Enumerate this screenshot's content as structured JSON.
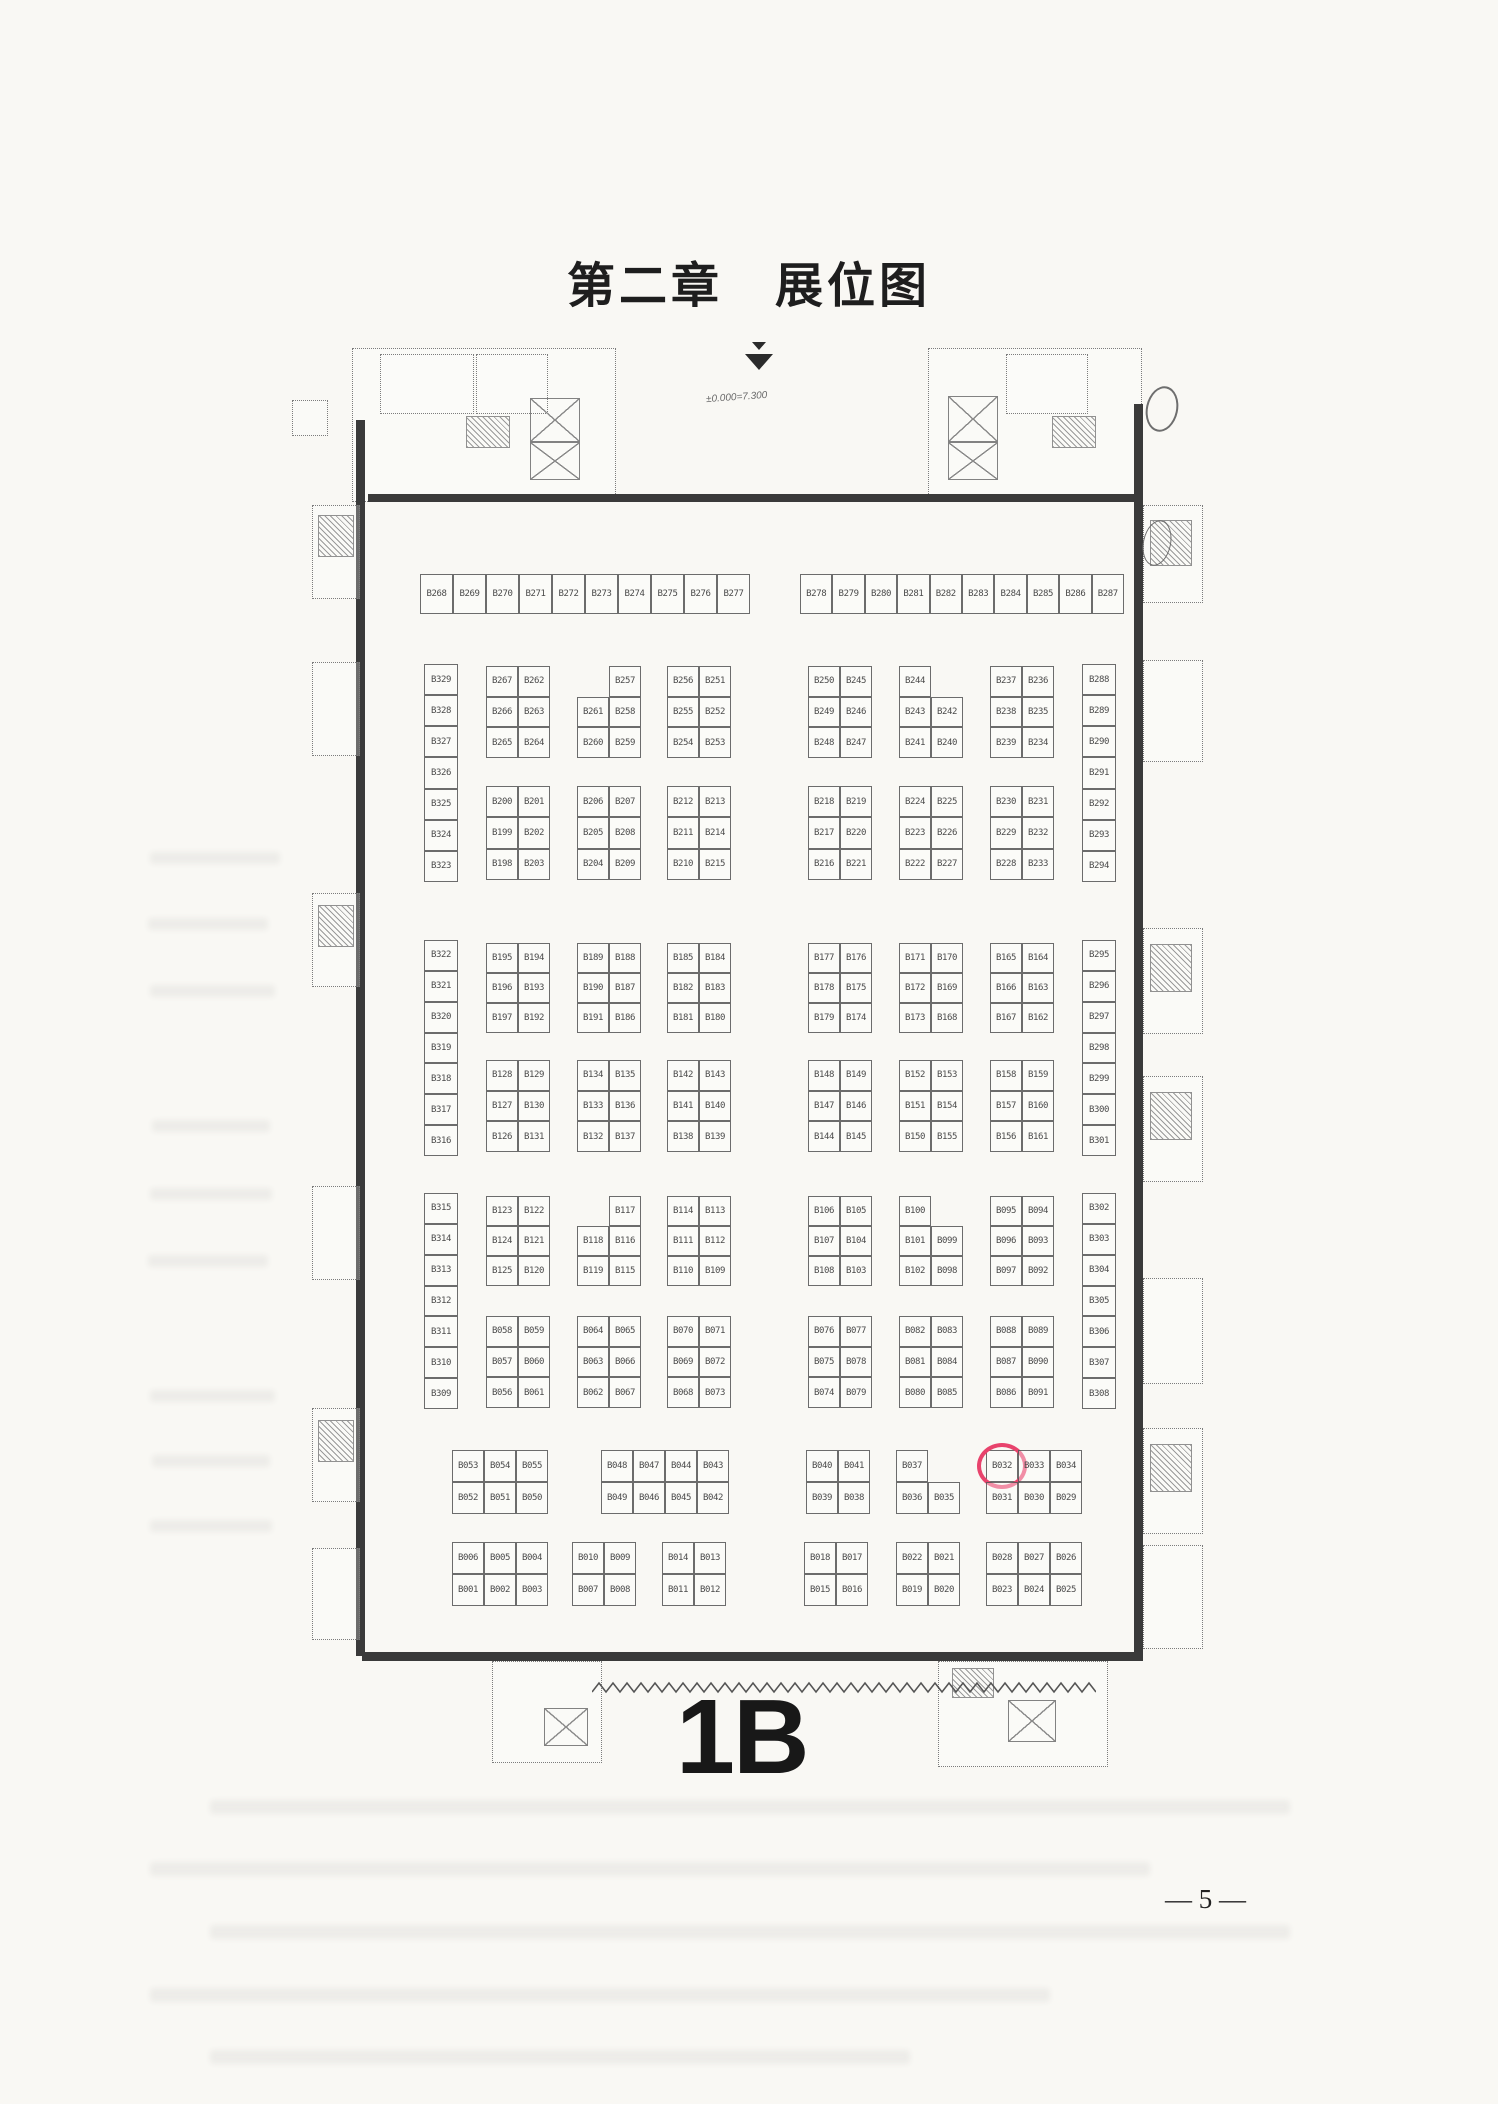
{
  "document": {
    "title": "第二章　展位图",
    "hall_label": "1B",
    "page_number": "— 5 —",
    "elevation_note": "±0.000=7.300",
    "highlighted_booth": "B032",
    "highlight_color": "#e8436c",
    "ink_color": "#3a3a3a",
    "paper_color": "#f9f8f4"
  },
  "plan": {
    "blocks": [
      {
        "x": 420,
        "y": 574,
        "w": 330,
        "h": 40,
        "cols": 10,
        "rows": 1,
        "cells": [
          "B268",
          "B269",
          "B270",
          "B271",
          "B272",
          "B273",
          "B274",
          "B275",
          "B276",
          "B277"
        ]
      },
      {
        "x": 800,
        "y": 574,
        "w": 324,
        "h": 40,
        "cols": 10,
        "rows": 1,
        "cells": [
          "B278",
          "B279",
          "B280",
          "B281",
          "B282",
          "B283",
          "B284",
          "B285",
          "B286",
          "B287"
        ]
      },
      {
        "x": 424,
        "y": 664,
        "w": 34,
        "h": 218,
        "cols": 1,
        "rows": 7,
        "cells": [
          "B329",
          "B328",
          "B327",
          "B326",
          "B325",
          "B324",
          "B323"
        ]
      },
      {
        "x": 486,
        "y": 666,
        "w": 64,
        "h": 92,
        "cols": 2,
        "rows": 3,
        "cells": [
          "B267",
          "B262",
          "B266",
          "B263",
          "B265",
          "B264"
        ]
      },
      {
        "x": 577,
        "y": 666,
        "w": 64,
        "h": 92,
        "cols": 2,
        "rows": 3,
        "cells": [
          "",
          "B257",
          "B261",
          "B258",
          "B260",
          "B259"
        ]
      },
      {
        "x": 667,
        "y": 666,
        "w": 64,
        "h": 92,
        "cols": 2,
        "rows": 3,
        "cells": [
          "B256",
          "B251",
          "B255",
          "B252",
          "B254",
          "B253"
        ]
      },
      {
        "x": 808,
        "y": 666,
        "w": 64,
        "h": 92,
        "cols": 2,
        "rows": 3,
        "cells": [
          "B250",
          "B245",
          "B249",
          "B246",
          "B248",
          "B247"
        ]
      },
      {
        "x": 899,
        "y": 666,
        "w": 64,
        "h": 92,
        "cols": 2,
        "rows": 3,
        "cells": [
          "B244",
          "",
          "B243",
          "B242",
          "B241",
          "B240"
        ]
      },
      {
        "x": 990,
        "y": 666,
        "w": 64,
        "h": 92,
        "cols": 2,
        "rows": 3,
        "cells": [
          "B237",
          "B236",
          "B238",
          "B235",
          "B239",
          "B234"
        ]
      },
      {
        "x": 1082,
        "y": 664,
        "w": 34,
        "h": 218,
        "cols": 1,
        "rows": 7,
        "cells": [
          "B288",
          "B289",
          "B290",
          "B291",
          "B292",
          "B293",
          "B294"
        ]
      },
      {
        "x": 486,
        "y": 786,
        "w": 64,
        "h": 94,
        "cols": 2,
        "rows": 3,
        "cells": [
          "B200",
          "B201",
          "B199",
          "B202",
          "B198",
          "B203"
        ]
      },
      {
        "x": 577,
        "y": 786,
        "w": 64,
        "h": 94,
        "cols": 2,
        "rows": 3,
        "cells": [
          "B206",
          "B207",
          "B205",
          "B208",
          "B204",
          "B209"
        ]
      },
      {
        "x": 667,
        "y": 786,
        "w": 64,
        "h": 94,
        "cols": 2,
        "rows": 3,
        "cells": [
          "B212",
          "B213",
          "B211",
          "B214",
          "B210",
          "B215"
        ]
      },
      {
        "x": 808,
        "y": 786,
        "w": 64,
        "h": 94,
        "cols": 2,
        "rows": 3,
        "cells": [
          "B218",
          "B219",
          "B217",
          "B220",
          "B216",
          "B221"
        ]
      },
      {
        "x": 899,
        "y": 786,
        "w": 64,
        "h": 94,
        "cols": 2,
        "rows": 3,
        "cells": [
          "B224",
          "B225",
          "B223",
          "B226",
          "B222",
          "B227"
        ]
      },
      {
        "x": 990,
        "y": 786,
        "w": 64,
        "h": 94,
        "cols": 2,
        "rows": 3,
        "cells": [
          "B230",
          "B231",
          "B229",
          "B232",
          "B228",
          "B233"
        ]
      },
      {
        "x": 424,
        "y": 940,
        "w": 34,
        "h": 216,
        "cols": 1,
        "rows": 7,
        "cells": [
          "B322",
          "B321",
          "B320",
          "B319",
          "B318",
          "B317",
          "B316"
        ]
      },
      {
        "x": 486,
        "y": 943,
        "w": 64,
        "h": 90,
        "cols": 2,
        "rows": 3,
        "cells": [
          "B195",
          "B194",
          "B196",
          "B193",
          "B197",
          "B192"
        ]
      },
      {
        "x": 577,
        "y": 943,
        "w": 64,
        "h": 90,
        "cols": 2,
        "rows": 3,
        "cells": [
          "B189",
          "B188",
          "B190",
          "B187",
          "B191",
          "B186"
        ]
      },
      {
        "x": 667,
        "y": 943,
        "w": 64,
        "h": 90,
        "cols": 2,
        "rows": 3,
        "cells": [
          "B185",
          "B184",
          "B182",
          "B183",
          "B181",
          "B180"
        ]
      },
      {
        "x": 808,
        "y": 943,
        "w": 64,
        "h": 90,
        "cols": 2,
        "rows": 3,
        "cells": [
          "B177",
          "B176",
          "B178",
          "B175",
          "B179",
          "B174"
        ]
      },
      {
        "x": 899,
        "y": 943,
        "w": 64,
        "h": 90,
        "cols": 2,
        "rows": 3,
        "cells": [
          "B171",
          "B170",
          "B172",
          "B169",
          "B173",
          "B168"
        ]
      },
      {
        "x": 990,
        "y": 943,
        "w": 64,
        "h": 90,
        "cols": 2,
        "rows": 3,
        "cells": [
          "B165",
          "B164",
          "B166",
          "B163",
          "B167",
          "B162"
        ]
      },
      {
        "x": 1082,
        "y": 940,
        "w": 34,
        "h": 216,
        "cols": 1,
        "rows": 7,
        "cells": [
          "B295",
          "B296",
          "B297",
          "B298",
          "B299",
          "B300",
          "B301"
        ]
      },
      {
        "x": 486,
        "y": 1060,
        "w": 64,
        "h": 92,
        "cols": 2,
        "rows": 3,
        "cells": [
          "B128",
          "B129",
          "B127",
          "B130",
          "B126",
          "B131"
        ]
      },
      {
        "x": 577,
        "y": 1060,
        "w": 64,
        "h": 92,
        "cols": 2,
        "rows": 3,
        "cells": [
          "B134",
          "B135",
          "B133",
          "B136",
          "B132",
          "B137"
        ]
      },
      {
        "x": 667,
        "y": 1060,
        "w": 64,
        "h": 92,
        "cols": 2,
        "rows": 3,
        "cells": [
          "B142",
          "B143",
          "B141",
          "B140",
          "B138",
          "B139"
        ]
      },
      {
        "x": 808,
        "y": 1060,
        "w": 64,
        "h": 92,
        "cols": 2,
        "rows": 3,
        "cells": [
          "B148",
          "B149",
          "B147",
          "B146",
          "B144",
          "B145"
        ]
      },
      {
        "x": 899,
        "y": 1060,
        "w": 64,
        "h": 92,
        "cols": 2,
        "rows": 3,
        "cells": [
          "B152",
          "B153",
          "B151",
          "B154",
          "B150",
          "B155"
        ]
      },
      {
        "x": 990,
        "y": 1060,
        "w": 64,
        "h": 92,
        "cols": 2,
        "rows": 3,
        "cells": [
          "B158",
          "B159",
          "B157",
          "B160",
          "B156",
          "B161"
        ]
      },
      {
        "x": 424,
        "y": 1193,
        "w": 34,
        "h": 216,
        "cols": 1,
        "rows": 7,
        "cells": [
          "B315",
          "B314",
          "B313",
          "B312",
          "B311",
          "B310",
          "B309"
        ]
      },
      {
        "x": 486,
        "y": 1196,
        "w": 64,
        "h": 90,
        "cols": 2,
        "rows": 3,
        "cells": [
          "B123",
          "B122",
          "B124",
          "B121",
          "B125",
          "B120"
        ]
      },
      {
        "x": 577,
        "y": 1196,
        "w": 64,
        "h": 90,
        "cols": 2,
        "rows": 3,
        "cells": [
          "",
          "B117",
          "B118",
          "B116",
          "B119",
          "B115"
        ]
      },
      {
        "x": 667,
        "y": 1196,
        "w": 64,
        "h": 90,
        "cols": 2,
        "rows": 3,
        "cells": [
          "B114",
          "B113",
          "B111",
          "B112",
          "B110",
          "B109"
        ]
      },
      {
        "x": 808,
        "y": 1196,
        "w": 64,
        "h": 90,
        "cols": 2,
        "rows": 3,
        "cells": [
          "B106",
          "B105",
          "B107",
          "B104",
          "B108",
          "B103"
        ]
      },
      {
        "x": 899,
        "y": 1196,
        "w": 64,
        "h": 90,
        "cols": 2,
        "rows": 3,
        "cells": [
          "B100",
          "",
          "B101",
          "B099",
          "B102",
          "B098"
        ]
      },
      {
        "x": 990,
        "y": 1196,
        "w": 64,
        "h": 90,
        "cols": 2,
        "rows": 3,
        "cells": [
          "B095",
          "B094",
          "B096",
          "B093",
          "B097",
          "B092"
        ]
      },
      {
        "x": 1082,
        "y": 1193,
        "w": 34,
        "h": 216,
        "cols": 1,
        "rows": 7,
        "cells": [
          "B302",
          "B303",
          "B304",
          "B305",
          "B306",
          "B307",
          "B308"
        ]
      },
      {
        "x": 486,
        "y": 1316,
        "w": 64,
        "h": 92,
        "cols": 2,
        "rows": 3,
        "cells": [
          "B058",
          "B059",
          "B057",
          "B060",
          "B056",
          "B061"
        ]
      },
      {
        "x": 577,
        "y": 1316,
        "w": 64,
        "h": 92,
        "cols": 2,
        "rows": 3,
        "cells": [
          "B064",
          "B065",
          "B063",
          "B066",
          "B062",
          "B067"
        ]
      },
      {
        "x": 667,
        "y": 1316,
        "w": 64,
        "h": 92,
        "cols": 2,
        "rows": 3,
        "cells": [
          "B070",
          "B071",
          "B069",
          "B072",
          "B068",
          "B073"
        ]
      },
      {
        "x": 808,
        "y": 1316,
        "w": 64,
        "h": 92,
        "cols": 2,
        "rows": 3,
        "cells": [
          "B076",
          "B077",
          "B075",
          "B078",
          "B074",
          "B079"
        ]
      },
      {
        "x": 899,
        "y": 1316,
        "w": 64,
        "h": 92,
        "cols": 2,
        "rows": 3,
        "cells": [
          "B082",
          "B083",
          "B081",
          "B084",
          "B080",
          "B085"
        ]
      },
      {
        "x": 990,
        "y": 1316,
        "w": 64,
        "h": 92,
        "cols": 2,
        "rows": 3,
        "cells": [
          "B088",
          "B089",
          "B087",
          "B090",
          "B086",
          "B091"
        ]
      },
      {
        "x": 452,
        "y": 1450,
        "w": 96,
        "h": 64,
        "cols": 3,
        "rows": 2,
        "cells": [
          "B053",
          "B054",
          "B055",
          "B052",
          "B051",
          "B050"
        ]
      },
      {
        "x": 601,
        "y": 1450,
        "w": 128,
        "h": 64,
        "cols": 4,
        "rows": 2,
        "cells": [
          "B048",
          "B047",
          "B044",
          "B043",
          "B049",
          "B046",
          "B045",
          "B042"
        ]
      },
      {
        "x": 806,
        "y": 1450,
        "w": 64,
        "h": 64,
        "cols": 2,
        "rows": 2,
        "cells": [
          "B040",
          "B041",
          "B039",
          "B038"
        ]
      },
      {
        "x": 896,
        "y": 1450,
        "w": 64,
        "h": 64,
        "cols": 2,
        "rows": 2,
        "cells": [
          "B037",
          "",
          "B036",
          "B035"
        ]
      },
      {
        "x": 986,
        "y": 1450,
        "w": 96,
        "h": 64,
        "cols": 3,
        "rows": 2,
        "cells": [
          "B032",
          "B033",
          "B034",
          "B031",
          "B030",
          "B029"
        ]
      },
      {
        "x": 452,
        "y": 1542,
        "w": 96,
        "h": 64,
        "cols": 3,
        "rows": 2,
        "cells": [
          "B006",
          "B005",
          "B004",
          "B001",
          "B002",
          "B003"
        ]
      },
      {
        "x": 572,
        "y": 1542,
        "w": 64,
        "h": 64,
        "cols": 2,
        "rows": 2,
        "cells": [
          "B010",
          "B009",
          "B007",
          "B008"
        ]
      },
      {
        "x": 662,
        "y": 1542,
        "w": 64,
        "h": 64,
        "cols": 2,
        "rows": 2,
        "cells": [
          "B014",
          "B013",
          "B011",
          "B012"
        ]
      },
      {
        "x": 804,
        "y": 1542,
        "w": 64,
        "h": 64,
        "cols": 2,
        "rows": 2,
        "cells": [
          "B018",
          "B017",
          "B015",
          "B016"
        ]
      },
      {
        "x": 896,
        "y": 1542,
        "w": 64,
        "h": 64,
        "cols": 2,
        "rows": 2,
        "cells": [
          "B022",
          "B021",
          "B019",
          "B020"
        ]
      },
      {
        "x": 986,
        "y": 1542,
        "w": 96,
        "h": 64,
        "cols": 3,
        "rows": 2,
        "cells": [
          "B028",
          "B027",
          "B026",
          "B023",
          "B024",
          "B025"
        ]
      }
    ]
  }
}
